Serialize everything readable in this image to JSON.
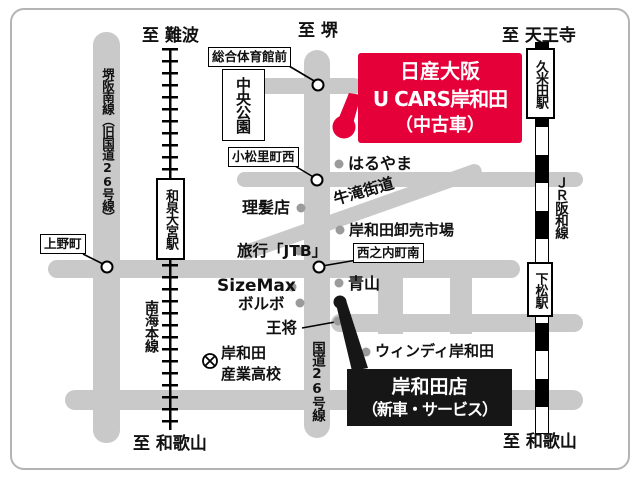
{
  "map": {
    "used_car_banner": {
      "line1": "日産大阪",
      "line2": "U CARS岸和田",
      "line3": "（中古車）",
      "color": "#e60039"
    },
    "new_car_banner": {
      "line1": "岸和田店",
      "line2": "（新車・サービス）",
      "color": "#161616"
    },
    "directions": {
      "namba": "至 難波",
      "sakai": "至 堺",
      "tennoji": "至 天王寺",
      "wakayama_left": "至 和歌山",
      "wakayama_right": "至 和歌山"
    },
    "roads": {
      "sakai_hannan_line": "堺阪南線（旧国道26号線）",
      "route26": "国道26号線",
      "ushitaki_kaido": "牛滝街道"
    },
    "railways": {
      "nankai_main_line": "南海本線",
      "jr_hanwa_line": "ＪＲ阪和線"
    },
    "stations": {
      "izumi_omiya": "和泉大宮駅",
      "kumeda": "久米田駅",
      "shimomatsu": "下松駅"
    },
    "intersections": {
      "sogo_taiikukan_mae": "総合体育館前",
      "komatsuri_cho_nishi": "小松里町西",
      "uenocho": "上野町",
      "nishinouchi_cho_minami": "西之内町南"
    },
    "landmarks": {
      "chuo_koen": "中央公園",
      "haruyama": "はるやま",
      "barber": "理髪店",
      "wholesale_market": "岸和田卸売市場",
      "jtb": "旅行「JTB」",
      "sizemax": "SizeMax",
      "volvo": "ボルボ",
      "aoyama": "青山",
      "osho": "王将",
      "windy_kishiwada": "ウィンディ岸和田",
      "sangyo_hs_line1": "岸和田",
      "sangyo_hs_line2": "産業高校"
    },
    "colors": {
      "road_gray": "#c9c9c9",
      "dot_gray": "#9b9b9b",
      "accent_red": "#e60039"
    }
  }
}
